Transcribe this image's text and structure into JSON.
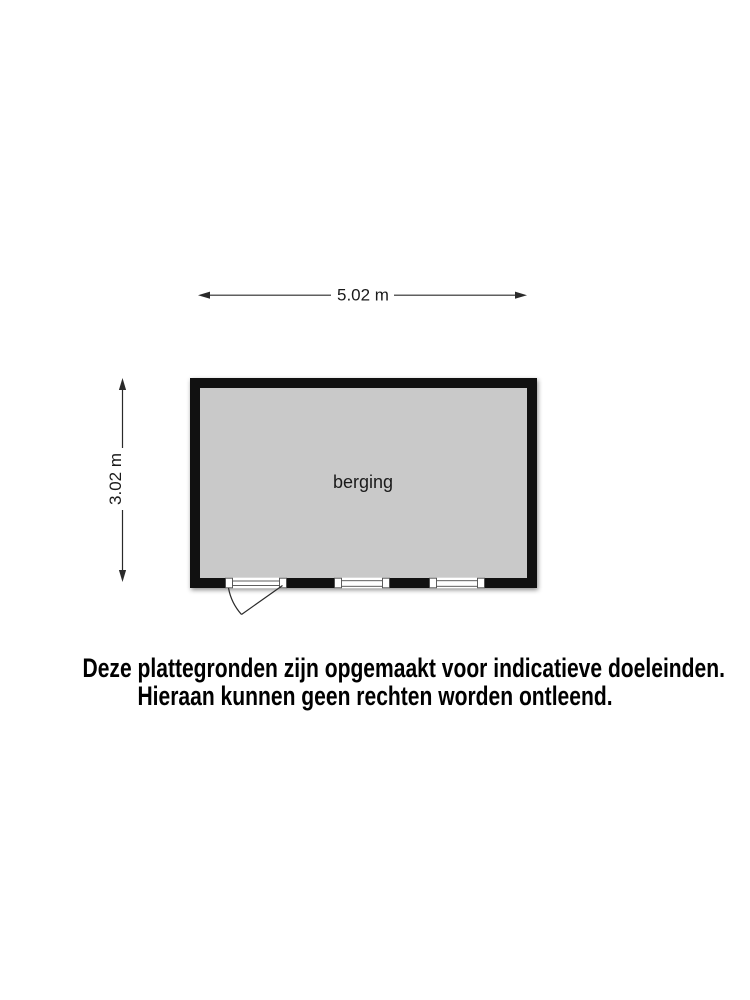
{
  "plan": {
    "room": {
      "label": "berging"
    },
    "dim_width": {
      "label": "5.02 m"
    },
    "dim_height": {
      "label": "3.02 m"
    },
    "colors": {
      "floor": "#c9c9c9",
      "wall": "#111111",
      "dim": "#2a2a2a",
      "label": "#1a1a1a"
    }
  },
  "disclaimer": {
    "line1": "Deze plattegronden zijn opgemaakt voor indicatieve doeleinden.",
    "line2": "Hieraan kunnen geen rechten worden ontleend."
  }
}
